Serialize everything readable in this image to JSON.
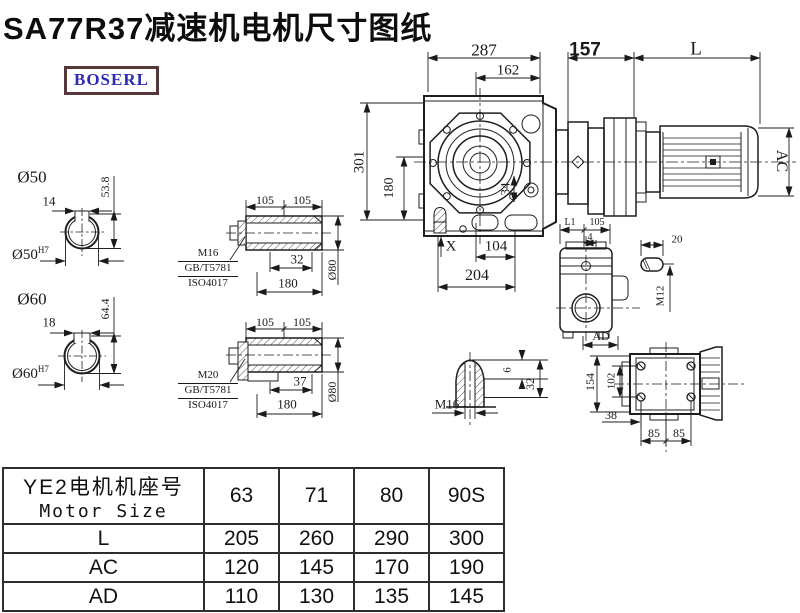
{
  "title": "SA77R37减速机电机尺寸图纸",
  "logo": {
    "text": "BOSERL"
  },
  "drawing": {
    "top_dims": {
      "d287": "287",
      "d162": "162",
      "d157": "157",
      "dL": "L"
    },
    "side_dims": {
      "d301": "301",
      "d180": "180",
      "d34": "34",
      "dAC": "AC"
    },
    "bottom_dims": {
      "dX": "X",
      "d104": "104",
      "d204": "204"
    },
    "shaft50": {
      "label": "Ø50",
      "key_width": "14",
      "depth": "53.8",
      "bore": "Ø50",
      "bore_tol": "H7"
    },
    "shaft60": {
      "label": "Ø60",
      "key_width": "18",
      "depth": "64.4",
      "bore": "Ø60",
      "bore_tol": "H7"
    },
    "hollow_shaft_a": {
      "d105a": "105",
      "d105b": "105",
      "bolt": "M16",
      "std": "GB/T5781",
      "iso": "ISO4017",
      "d32": "32",
      "d180": "180",
      "dia": "Ø80"
    },
    "hollow_shaft_b": {
      "d105a": "105",
      "d105b": "105",
      "bolt": "M20",
      "std": "GB/T5781",
      "iso": "ISO4017",
      "d37": "37",
      "d180": "180",
      "dia": "Ø80"
    },
    "rear_view": {
      "dL1": "L1",
      "d105": "105",
      "d4": "4",
      "dAD": "AD"
    },
    "key_detail": {
      "d20": "20",
      "thread": "M12"
    },
    "flange_view": {
      "d154": "154",
      "d102": "102",
      "d38": "38",
      "d85a": "85",
      "d85b": "85"
    },
    "plug_detail": {
      "d6": "6",
      "d32": "32",
      "thread": "M16"
    }
  },
  "table": {
    "header_cn": "YE2电机机座号",
    "header_en": "Motor Size",
    "sizes": [
      "63",
      "71",
      "80",
      "90S"
    ],
    "rows": [
      {
        "label": "L",
        "values": [
          "205",
          "260",
          "290",
          "300"
        ]
      },
      {
        "label": "AC",
        "values": [
          "120",
          "145",
          "170",
          "190"
        ]
      },
      {
        "label": "AD",
        "values": [
          "110",
          "130",
          "135",
          "145"
        ]
      }
    ]
  }
}
